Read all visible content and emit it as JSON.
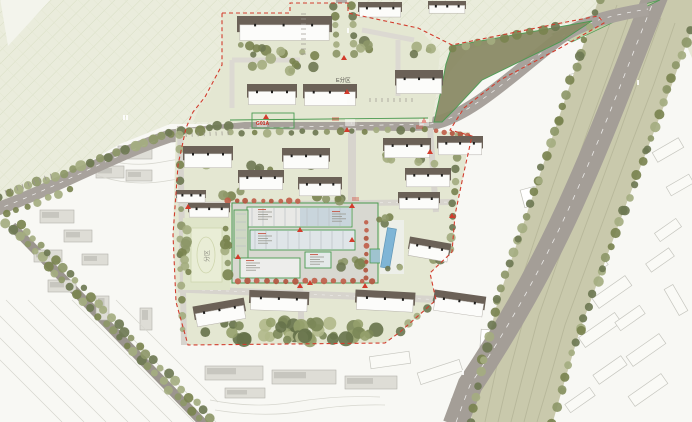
{
  "map": {
    "type": "architectural-master-plan",
    "zone_label": "E分区",
    "parcel_code": "G01A",
    "park_zone_label": "分区"
  },
  "colors": {
    "boundary_red": "#D23C2D",
    "parcel_green": "#4A9A50",
    "road_gray": "#A8A29C",
    "rail_corridor_olive": "#C9C9AC",
    "hillside_green": "#EAECDC",
    "tree_olive": "#8D9768",
    "tree_accent_orange": "#B2563F",
    "pool_blue": "#7FB5D6",
    "building_roof_taupe": "#6B6157"
  }
}
